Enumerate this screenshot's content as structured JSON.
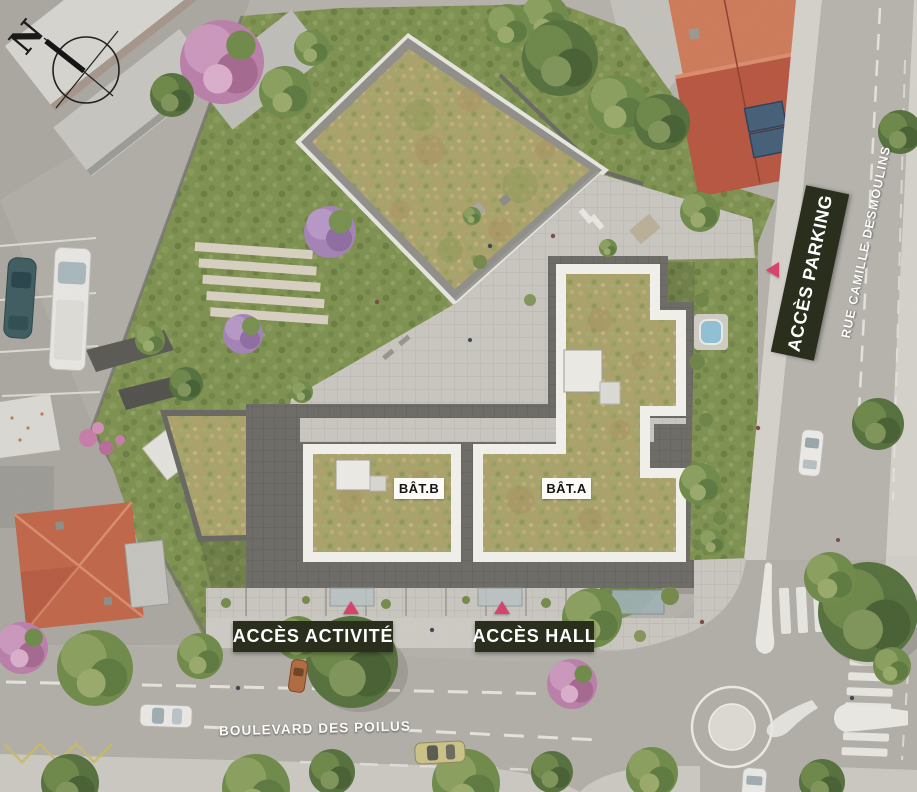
{
  "plan": {
    "compass_label": "N",
    "buildings": {
      "bat_b": "BÂT.B",
      "bat_a": "BÂT.A"
    },
    "access": {
      "parking": "ACCÈS PARKING",
      "activite": "ACCÈS ACTIVITÉ",
      "hall": "ACCÈS HALL"
    },
    "streets": {
      "rue": "RUE CAMILLE DESMOULINS",
      "boulevard": "BOULEVARD DES POILUS"
    },
    "colors": {
      "access_banner_bg": "#2a2e1d",
      "access_banner_text": "#ffffff",
      "entrance_marker": "#d6436f",
      "green_roof": "#a8a26a",
      "lawn": "#7e9150",
      "road": "#b1aea8",
      "sidewalk": "#d4d1cb",
      "parapet_white": "#f2f0ea",
      "red_roof": "#b65640",
      "label_box_bg": "#fcfbf7"
    }
  }
}
